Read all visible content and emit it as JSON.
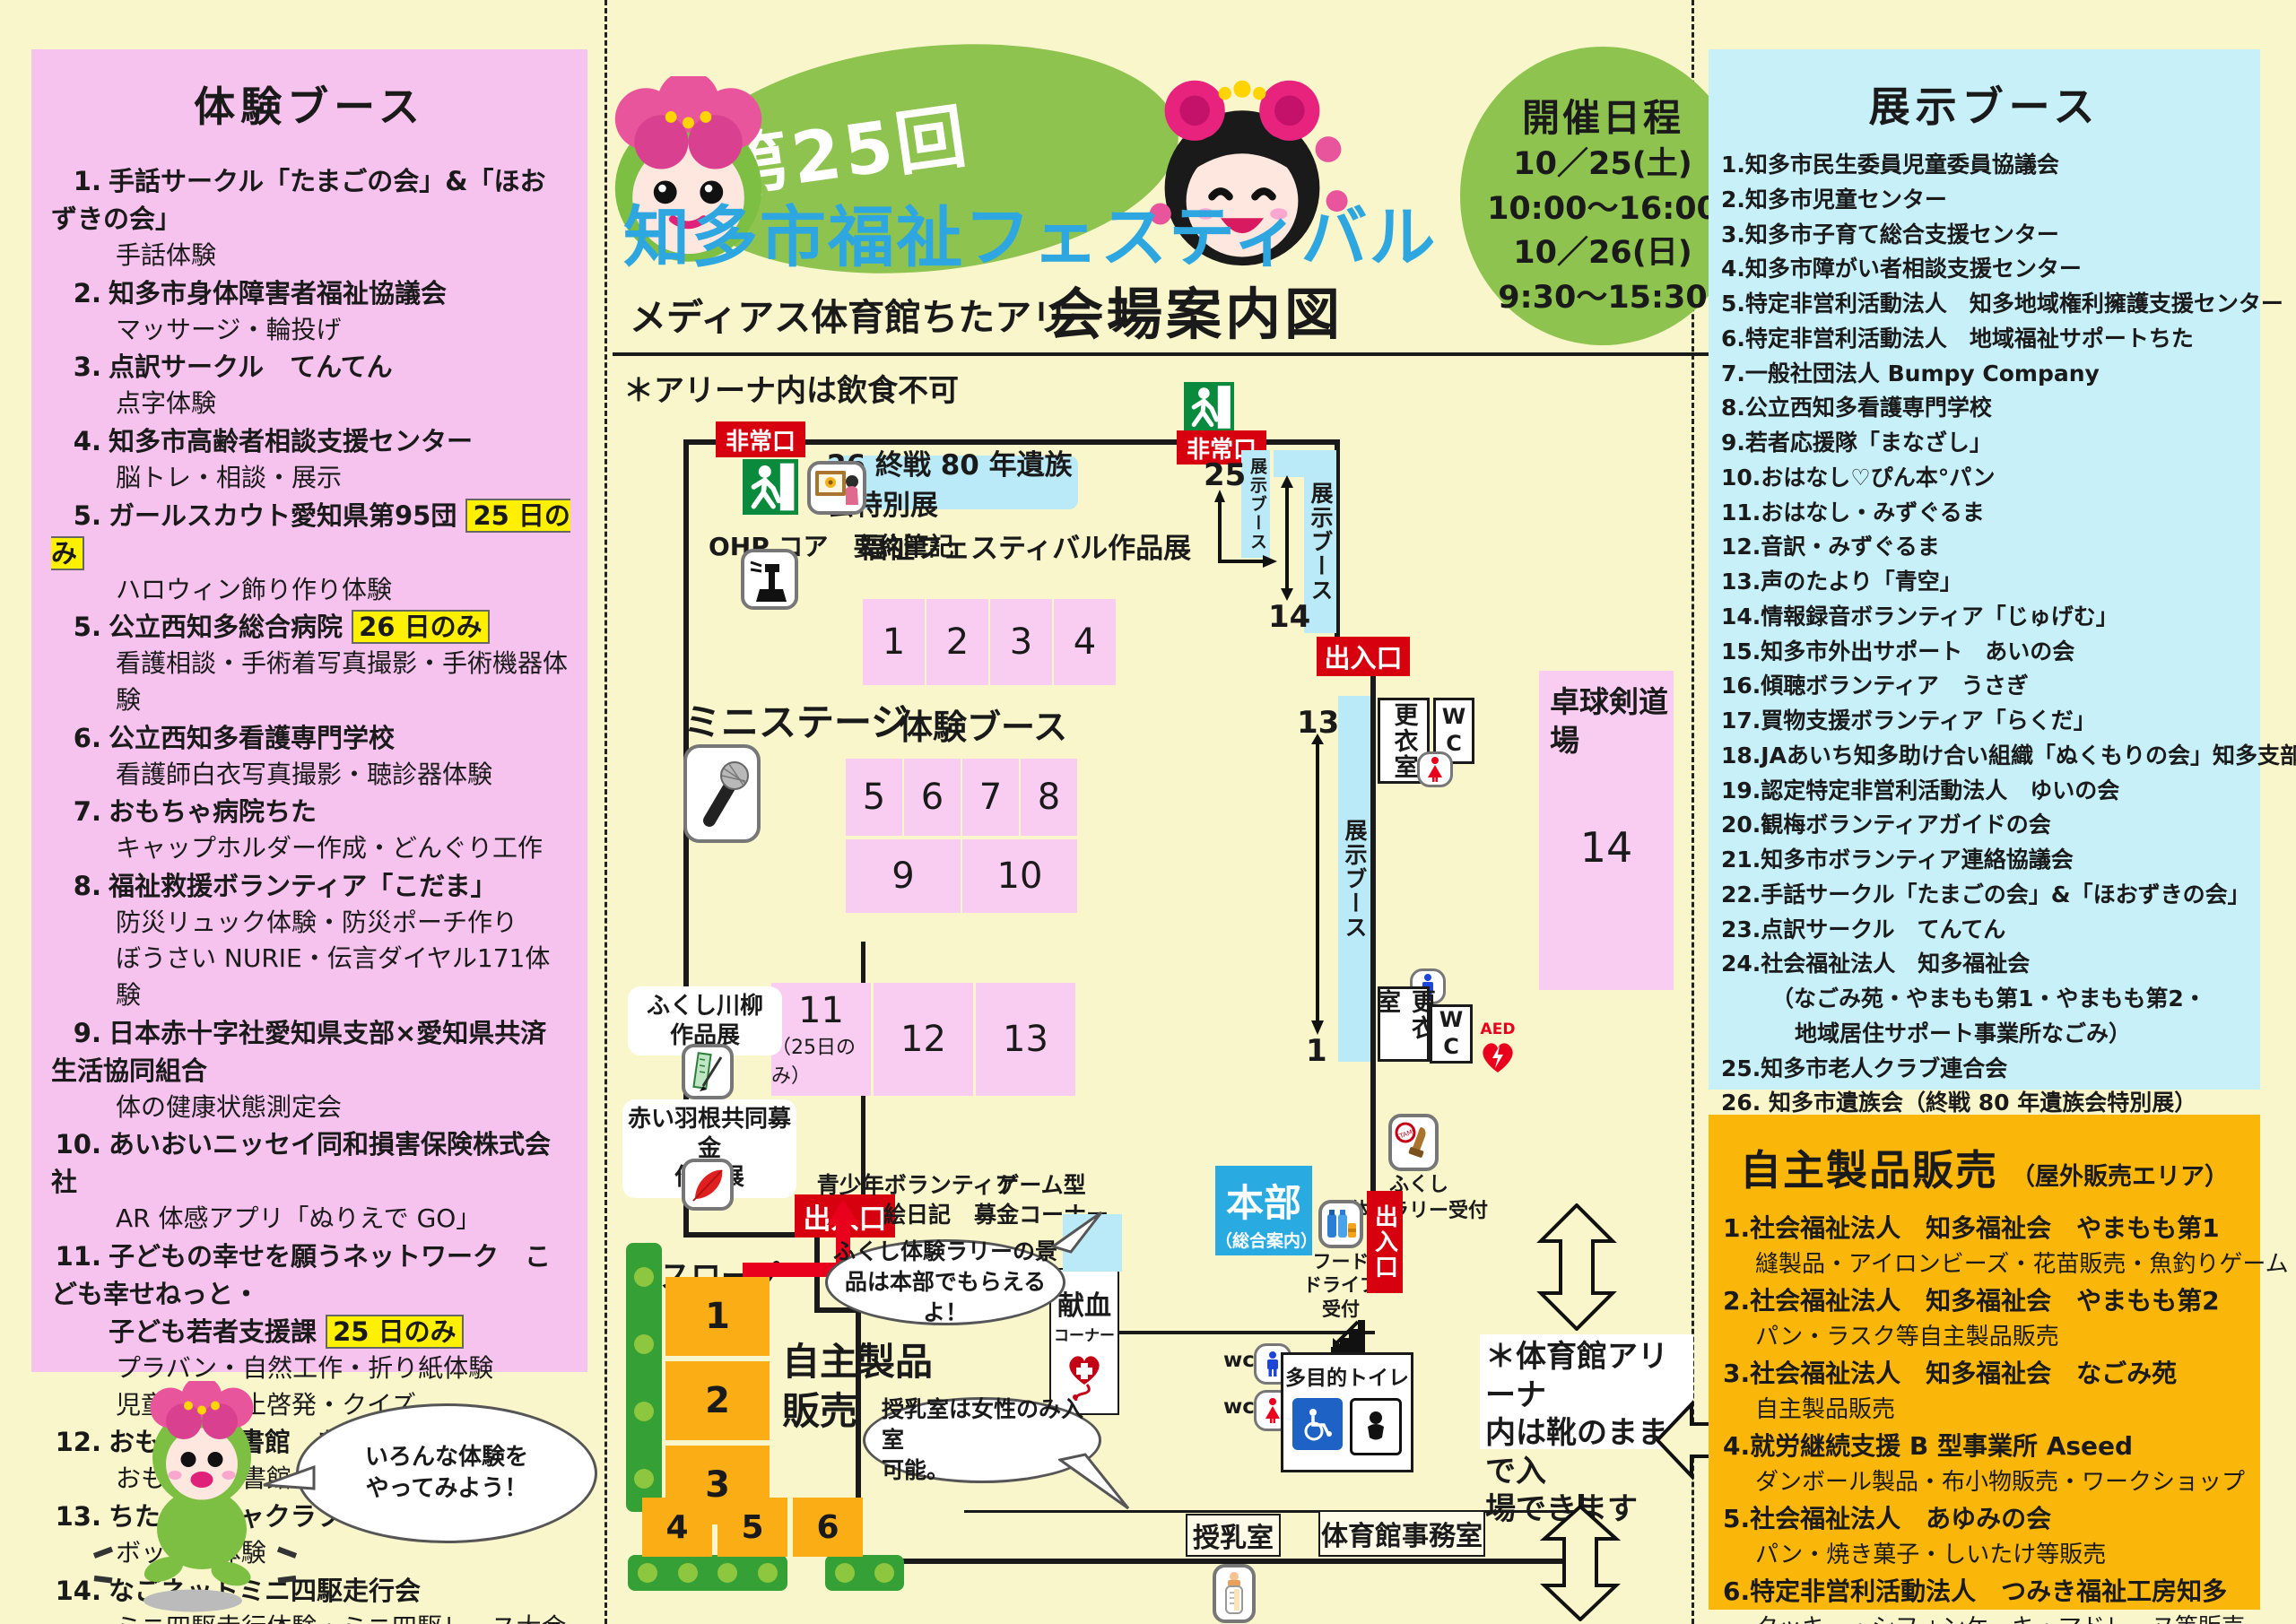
{
  "header": {
    "badge": "第25回",
    "title": "知多市福祉フェスティバル",
    "venue": "メディアス体育館ちたアリーナ",
    "map_heading": "会場案内図",
    "schedule": {
      "title": "開催日程",
      "line1": "10／25(土)",
      "line2": "10:00～16:00",
      "line3": "10／26(日)",
      "line4": "9:30～15:30"
    }
  },
  "experience": {
    "title": "体験ブース",
    "items": [
      {
        "no": "1.",
        "name": "手話サークル「たまごの会」&「ほおずきの会」",
        "subs": [
          "手話体験"
        ]
      },
      {
        "no": "2.",
        "name": "知多市身体障害者福祉協議会",
        "subs": [
          "マッサージ・輪投げ"
        ]
      },
      {
        "no": "3.",
        "name": "点訳サークル　てんてん",
        "subs": [
          "点字体験"
        ]
      },
      {
        "no": "4.",
        "name": "知多市高齢者相談支援センター",
        "subs": [
          "脳トレ・相談・展示"
        ]
      },
      {
        "no": "5.",
        "name": "ガールスカウト愛知県第95団",
        "badge": "25 日のみ",
        "subs": [
          "ハロウィン飾り作り体験"
        ]
      },
      {
        "no": "5.",
        "name": "公立西知多総合病院",
        "badge": "26 日のみ",
        "subs": [
          "看護相談・手術着写真撮影・手術機器体験"
        ]
      },
      {
        "no": "6.",
        "name": "公立西知多看護専門学校",
        "subs": [
          "看護師白衣写真撮影・聴診器体験"
        ]
      },
      {
        "no": "7.",
        "name": "おもちゃ病院ちた",
        "subs": [
          "キャップホルダー作成・どんぐり工作"
        ]
      },
      {
        "no": "8.",
        "name": "福祉救援ボランティア「こだま」",
        "subs": [
          "防災リュック体験・防災ポーチ作り",
          "ぼうさい NURIE・伝言ダイヤル171体験"
        ]
      },
      {
        "no": "9.",
        "name": "日本赤十字社愛知県支部×愛知県共済生活協同組合",
        "subs": [
          "体の健康状態測定会"
        ]
      },
      {
        "no": "10.",
        "name": "あいおいニッセイ同和損害保険株式会社",
        "subs": [
          "AR 体感アプリ「ぬりえで GO」"
        ]
      },
      {
        "no": "11.",
        "name": "子どもの幸せを願うネットワーク　こども幸せねっと・",
        "name2": "子ども若者支援課",
        "badge": "25 日のみ",
        "subs": [
          "プラバン・自然工作・折り紙体験",
          "児童虐待防止啓発・クイズ"
        ]
      },
      {
        "no": "12.",
        "name": "おもちゃ図書館　あぷりこっと",
        "subs": [
          "おもちゃ図書館"
        ]
      },
      {
        "no": "13.",
        "name": "ちたボッチャクラブ",
        "subs": [
          "ボッチャ体験"
        ]
      },
      {
        "no": "14.",
        "name": "なごネットミニ四駆走行会",
        "subs": [
          "ミニ四駆走行体験・ミニ四駆レース大会"
        ]
      }
    ],
    "bubble1": "いろんな体験を",
    "bubble2": "やってみよう！"
  },
  "exhibit": {
    "title": "展示ブース",
    "lines": [
      "1.知多市民生委員児童委員協議会",
      "2.知多市児童センター",
      "3.知多市子育て総合支援センター",
      "4.知多市障がい者相談支援センター",
      "5.特定非営利活動法人　知多地域権利擁護支援センター",
      "6.特定非営利活動法人　地域福祉サポートちた",
      "7.一般社団法人 Bumpy Company",
      "8.公立西知多看護専門学校",
      "9.若者応援隊「まなざし」",
      "10.おはなし♡ぴん本°パン",
      "11.おはなし・みずぐるま",
      "12.音訳・みずぐるま",
      "13.声のたより「青空」",
      "14.情報録音ボランティア「じゅげむ」",
      "15.知多市外出サポート　あいの会",
      "16.傾聴ボランティア　うさぎ",
      "17.買物支援ボランティア「らくだ」",
      "18.JAあいち知多助け合い組織「ぬくもりの会」知多支部",
      "19.認定特定非営利活動法人　ゆいの会",
      "20.観梅ボランティアガイドの会",
      "21.知多市ボランティア連絡協議会",
      "22.手話サークル「たまごの会」&「ほおずきの会」",
      "23.点訳サークル　てんてん",
      "24.社会福祉法人　知多福祉会",
      "（なごみ苑・やまもも第1・やまもも第2・",
      "地域居住サポート事業所なごみ）",
      "25.知多市老人クラブ連合会",
      "26. 知多市遺族会（終戦 80 年遺族会特別展）"
    ]
  },
  "sales": {
    "title": "自主製品販売",
    "subtitle": "（屋外販売エリア）",
    "items": [
      {
        "name": "1.社会福祉法人　知多福祉会　やまもも第1",
        "sub": "縫製品・アイロンビーズ・花苗販売・魚釣りゲーム"
      },
      {
        "name": "2.社会福祉法人　知多福祉会　やまもも第2",
        "sub": "パン・ラスク等自主製品販売"
      },
      {
        "name": "3.社会福祉法人　知多福祉会　なごみ苑",
        "sub": "自主製品販売"
      },
      {
        "name": "4.就労継続支援 B 型事業所 Aseed",
        "sub": "ダンボール製品・布小物販売・ワークショップ"
      },
      {
        "name": "5.社会福祉法人　あゆみの会",
        "sub": "パン・焼き菓子・しいたけ等販売"
      },
      {
        "name": "6.特定非営利活動法人　つみき福祉工房知多",
        "sub": "クッキー・シフォンケーキ・マドレーヌ等販売"
      }
    ]
  },
  "map": {
    "note": "＊アリーナ内は飲食不可",
    "emergency_exit": "非常口",
    "exit": "出入口",
    "special_expo": "26 終戦 80 年遺族会特別展",
    "works_expo": "福祉フェスティバル作品展",
    "ohp_label": "OHP コア　要約筆記",
    "mini_stage": "ミニステージ",
    "taiken_label": "体験ブース",
    "tenji_label": "展示ブース",
    "num25": "25",
    "num14": "14",
    "num13": "13",
    "num1": "1",
    "senryu_l1": "ふくし川柳",
    "senryu_l2": "作品展",
    "akaihane_l1": "赤い羽根共同募金",
    "akaihane_l2": "作品展",
    "slope": "スロープ",
    "kenketsu_l1": "献血",
    "kenketsu_l2": "コーナー",
    "seishonen_l1": "青少年ボランティア",
    "seishonen_l2": "絵日記",
    "game_l1": "ゲーム型",
    "game_l2": "募金コーナー",
    "honbu": "本部",
    "honbu_sub": "（総合案内）",
    "food_l1": "フード",
    "food_l2": "ドライブ",
    "food_l3": "受付",
    "rally_l1": "ふくし",
    "rally_l2": "体験ラリー受付",
    "kouishitsu": "更衣室",
    "wc": "WC",
    "wc_small": "wc",
    "aed": "AED",
    "takkyu_l1": "卓球剣道",
    "takkyu_l2": "場",
    "takkyu_no": "14",
    "tamokuteki": "多目的トイレ",
    "bubble1_l1": "ふくし体験ラリーの景",
    "bubble1_l2": "品は本部でもらえるよ！",
    "bubble2_l1": "授乳室は女性のみ入室",
    "bubble2_l2": "可能。",
    "junyu": "授乳室",
    "jimu": "体育館事務室",
    "shoes_l1": "＊体育館アリーナ",
    "shoes_l2": "内は靴のままで入",
    "shoes_l3": "場できます",
    "jishu_l1": "自主製品",
    "jishu_l2": "販売",
    "day25_only": "（25日のみ）",
    "booths_row1": [
      "1",
      "2",
      "3",
      "4"
    ],
    "booths_row2": [
      "5",
      "6",
      "7",
      "8"
    ],
    "booths_row3": [
      "9",
      "10"
    ],
    "booths_row4": [
      "11",
      "12",
      "13"
    ],
    "sales_left": [
      "1",
      "2",
      "3"
    ],
    "sales_bottom": [
      "4",
      "5",
      "6"
    ]
  }
}
